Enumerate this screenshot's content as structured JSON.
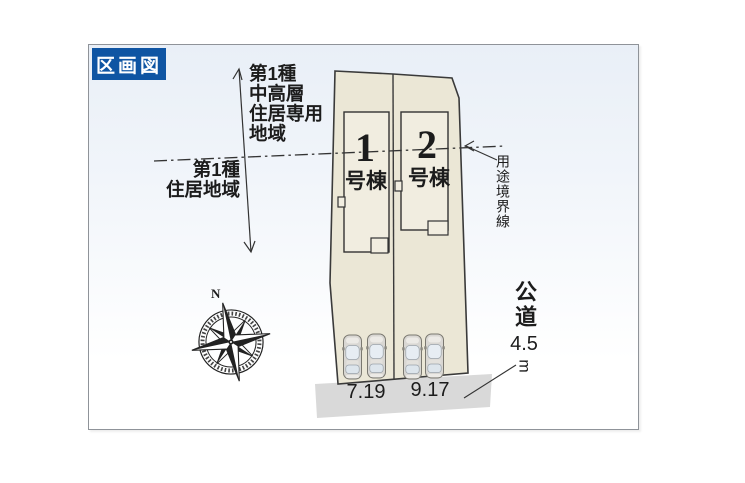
{
  "badge": {
    "label": "区画図"
  },
  "zoning": {
    "upper_area_label": "第1種\n中高層\n住居専用\n地域",
    "lower_area_label": "第1種\n住居地域",
    "boundary_label": "用途境界線"
  },
  "plots": [
    {
      "number": "1",
      "suffix": "号棟",
      "frontage": "7.19"
    },
    {
      "number": "2",
      "suffix": "号棟",
      "frontage": "9.17"
    }
  ],
  "road": {
    "name": "公道",
    "width_value": "4.5",
    "width_unit": "m"
  },
  "compass": {
    "north_label": "N"
  },
  "colors": {
    "badge_bg": "#0f55a3",
    "parcel_fill": "#ebe7d6",
    "building_fill": "#f1ede0",
    "road_fill": "#d9d9d9",
    "line": "#2e2e2e"
  }
}
